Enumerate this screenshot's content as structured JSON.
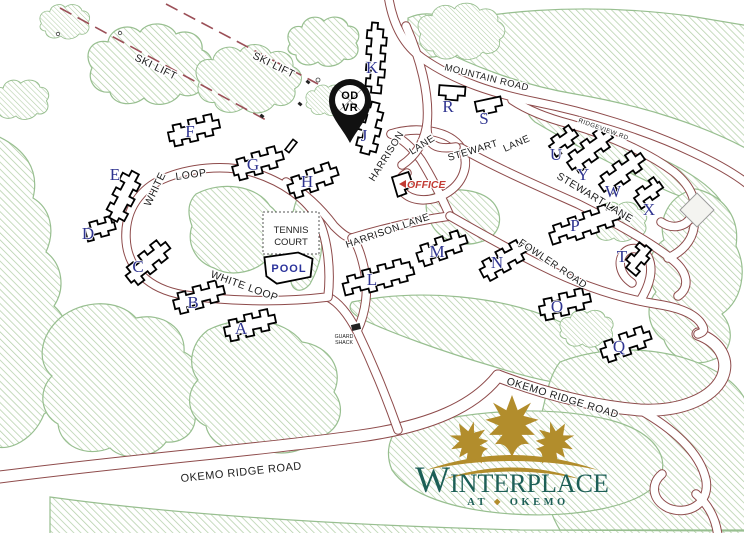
{
  "map": {
    "logo": {
      "title_w": "W",
      "title_rest": "INTERPLACE",
      "subtitle_at": "AT",
      "subtitle_sep": "◆",
      "subtitle_okemo": "OKEMO"
    },
    "pin": {
      "line1": "OD",
      "line2": "VR"
    },
    "roads": {
      "ski_lift_upper": "SKI LIFT",
      "ski_lift_lower": "SKI LIFT",
      "mountain_road": "MOUNTAIN ROAD",
      "ridgeview_rd": "RIDGEVIEW RD",
      "harrison_upper_word1": "HARRISON",
      "harrison_upper_word2": "LANE",
      "harrison_lane_lower": "HARRISON LANE",
      "stewart_upper_word1": "STEWART",
      "stewart_upper_word2": "LANE",
      "stewart_lane_lower": "STEWART LANE",
      "white_upper_word1": "WHITE",
      "white_upper_word2": "LOOP",
      "white_loop_lower": "WHITE LOOP",
      "fowler_road": "FOWLER ROAD",
      "okemo_ridge_road_upper": "OKEMO RIDGE ROAD",
      "okemo_ridge_road_lower": "OKEMO RIDGE ROAD"
    },
    "facilities": {
      "tennis_court_line1": "TENNIS",
      "tennis_court_line2": "COURT",
      "pool": "POOL",
      "office": "OFFICE",
      "guard_shack_line1": "GUARD",
      "guard_shack_line2": "SHACK"
    },
    "buildings": [
      {
        "label": "A"
      },
      {
        "label": "B"
      },
      {
        "label": "C"
      },
      {
        "label": "D"
      },
      {
        "label": "E"
      },
      {
        "label": "F"
      },
      {
        "label": "G"
      },
      {
        "label": "H"
      },
      {
        "label": "J"
      },
      {
        "label": "K"
      },
      {
        "label": "L"
      },
      {
        "label": "M"
      },
      {
        "label": "N"
      },
      {
        "label": "O"
      },
      {
        "label": "P"
      },
      {
        "label": "Q"
      },
      {
        "label": "R"
      },
      {
        "label": "S"
      },
      {
        "label": "T"
      },
      {
        "label": "U"
      },
      {
        "label": "W"
      },
      {
        "label": "X"
      },
      {
        "label": "Y"
      }
    ],
    "colors": {
      "road_line": "#8e4b4b",
      "ski_lift_line": "#9b4f57",
      "tree_outline": "#98bf90",
      "tree_hatch": "#b4cfa9",
      "building_outline": "#000000",
      "building_letter": "#2f3490",
      "office_text": "#c23b33",
      "pool_text": "#2b339b",
      "logo_teal": "#1d5f57",
      "logo_gold": "#b28d2c",
      "pin_fill": "#111111"
    }
  }
}
